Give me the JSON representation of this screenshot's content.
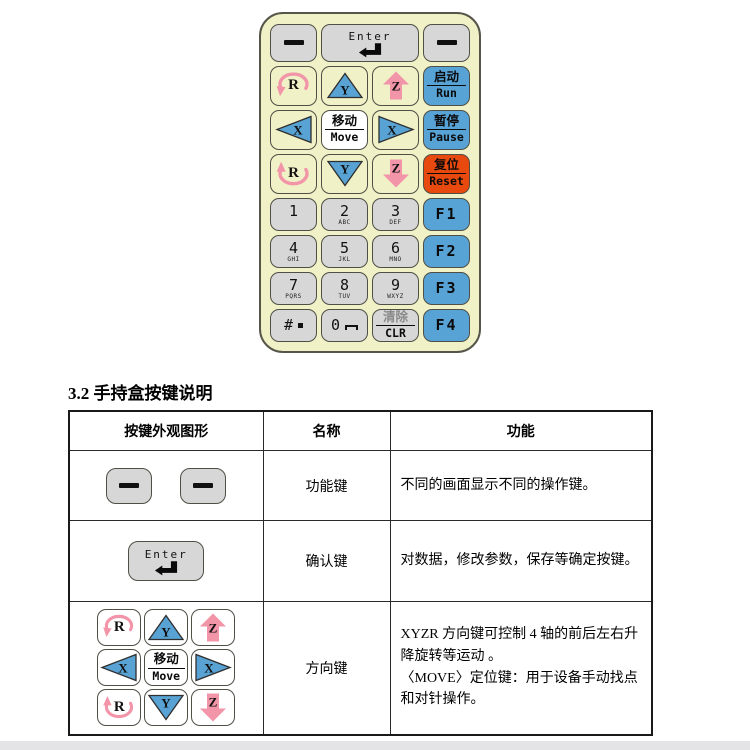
{
  "document": {
    "section_heading": "3.2 手持盒按键说明"
  },
  "keypad": {
    "enter_label": "Enter",
    "keys": {
      "r_ccw": "R",
      "y_up": "Y",
      "z_up": "Z",
      "x_left": "X",
      "move_cn": "移动",
      "move_en": "Move",
      "x_right": "X",
      "r_cw": "R",
      "y_down": "Y",
      "z_down": "Z",
      "run_cn": "启动",
      "run_en": "Run",
      "pause_cn": "暂停",
      "pause_en": "Pause",
      "reset_cn": "复位",
      "reset_en": "Reset",
      "clear_cn": "清除",
      "clear_en": "CLR",
      "hash": "#",
      "zero": "0"
    },
    "digits": [
      {
        "d": "1",
        "letters": ""
      },
      {
        "d": "2",
        "letters": "ABC"
      },
      {
        "d": "3",
        "letters": "DEF"
      },
      {
        "d": "4",
        "letters": "GHI"
      },
      {
        "d": "5",
        "letters": "JKL"
      },
      {
        "d": "6",
        "letters": "MNO"
      },
      {
        "d": "7",
        "letters": "PQRS"
      },
      {
        "d": "8",
        "letters": "TUV"
      },
      {
        "d": "9",
        "letters": "WXYZ"
      }
    ],
    "fkeys": [
      "F1",
      "F2",
      "F3",
      "F4"
    ]
  },
  "table": {
    "headers": [
      "按键外观图形",
      "名称",
      "功能"
    ],
    "rows": [
      {
        "name": "功能键",
        "function": "不同的画面显示不同的操作键。"
      },
      {
        "name": "确认键",
        "function": "对数据，修改参数，保存等确定按键。"
      },
      {
        "name": "方向键",
        "function_line1": "XYZR 方向键可控制 4 轴的前后左右升降旋转等运动 。",
        "function_line2": "〈MOVE〉定位键：用于设备手动找点和对针操作。"
      }
    ]
  },
  "colors": {
    "keypad_body": "#f0f1c6",
    "key_gray": "#d7d7d7",
    "key_blue": "#58a3d6",
    "key_reset_orange": "#e8490f",
    "arrow_pink": "#f295a9",
    "triangle_blue": "#58a2d4",
    "footer_strip_gray": "#e4e4e6"
  }
}
